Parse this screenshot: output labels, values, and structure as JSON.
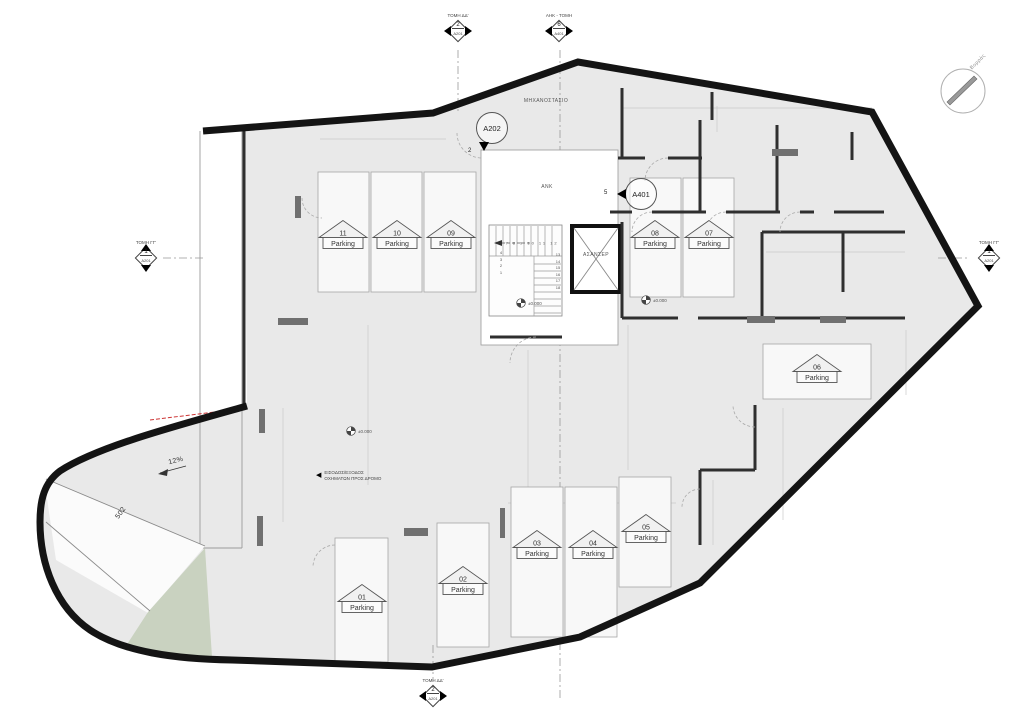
{
  "plan": {
    "labels": {
      "machine_room": "ΜΗΧΑΝΟΣΤΑΣΙΟ",
      "elevator_lobby": "ΑΝΚ",
      "elevator": "ΑΣΑΝΣΕΡ",
      "north": "Βορράς",
      "ramp_slope": "12%",
      "ramp_width": "502",
      "exit_note_line1": "ΕΙΣΟΔΟΣ/ΕΞΟΔΟΣ",
      "exit_note_line2": "ΟΧΗΜΑΤΩΝ ΠΡΟΣ ΔΡΟΜΟ"
    },
    "stairs": {
      "run_numbers": "7 8 9 10 11 12",
      "left_numbers": "4 3 2 1",
      "side_numbers": "13 14 15 16 17 18"
    },
    "colors": {
      "wall": "#141414",
      "floor": "#e9e9e9",
      "green_area": "#c9d2c0",
      "red_line": "#cc3333"
    }
  },
  "section_markers": [
    {
      "label": "ΤΟΜΗ ΔΔ'",
      "number": "2",
      "sheet": "A201",
      "x": 458,
      "y": 28,
      "orient": "h"
    },
    {
      "label": "ΑΗΚ - ΤΟΜΗ",
      "number": "6",
      "sheet": "A401",
      "x": 559,
      "y": 28,
      "orient": "h"
    },
    {
      "label": "ΤΟΜΗ ΓΓ'",
      "number": "1",
      "sheet": "A201",
      "x": 146,
      "y": 255,
      "orient": "v"
    },
    {
      "label": "ΤΟΜΗ ΓΓ'",
      "number": "1",
      "sheet": "A201",
      "x": 989,
      "y": 255,
      "orient": "v"
    },
    {
      "label": "ΤΟΜΗ ΔΔ'",
      "number": "2",
      "sheet": "A201",
      "x": 433,
      "y": 693,
      "orient": "h"
    }
  ],
  "detail_markers": [
    {
      "label": "A202",
      "number": "2",
      "x": 492,
      "y": 128,
      "orient": "down"
    },
    {
      "label": "A401",
      "number": "5",
      "x": 641,
      "y": 194,
      "orient": "left"
    }
  ],
  "parking": {
    "label": "Parking",
    "spaces": [
      {
        "number": "01",
        "x": 362,
        "y": 601
      },
      {
        "number": "02",
        "x": 463,
        "y": 583
      },
      {
        "number": "03",
        "x": 537,
        "y": 547
      },
      {
        "number": "04",
        "x": 593,
        "y": 547
      },
      {
        "number": "05",
        "x": 646,
        "y": 531
      },
      {
        "number": "06",
        "x": 817,
        "y": 371
      },
      {
        "number": "07",
        "x": 709,
        "y": 237
      },
      {
        "number": "08",
        "x": 655,
        "y": 237
      },
      {
        "number": "09",
        "x": 451,
        "y": 237
      },
      {
        "number": "10",
        "x": 397,
        "y": 237
      },
      {
        "number": "11",
        "x": 343,
        "y": 237
      }
    ]
  },
  "dimensions": [
    {
      "v": "877",
      "x": 383,
      "y": 135
    },
    {
      "v": "325",
      "x": 662,
      "y": 104
    },
    {
      "v": "300",
      "x": 748,
      "y": 104
    },
    {
      "v": "425",
      "x": 843,
      "y": 104
    },
    {
      "v": "70",
      "x": 717,
      "y": 118,
      "rot": 90
    },
    {
      "v": "275",
      "x": 800,
      "y": 249
    },
    {
      "v": "350",
      "x": 866,
      "y": 247
    },
    {
      "v": "558",
      "x": 548,
      "y": 291
    },
    {
      "v": "92",
      "x": 601,
      "y": 296,
      "rot": 90
    },
    {
      "v": "720",
      "x": 590,
      "y": 501
    },
    {
      "v": "215",
      "x": 713,
      "y": 511,
      "rot": 90
    },
    {
      "v": "405",
      "x": 699,
      "y": 526,
      "rot": 90
    },
    {
      "v": "1100",
      "x": 368,
      "y": 407,
      "rot": 90
    },
    {
      "v": "860",
      "x": 528,
      "y": 419,
      "rot": 90
    },
    {
      "v": "620",
      "x": 628,
      "y": 397,
      "rot": 90
    },
    {
      "v": "460",
      "x": 283,
      "y": 467,
      "rot": 90
    },
    {
      "v": "278",
      "x": 783,
      "y": 466,
      "rot": 90
    },
    {
      "v": "300",
      "x": 906,
      "y": 362,
      "rot": 90
    },
    {
      "v": "90",
      "x": 306,
      "y": 377
    },
    {
      "v": "80",
      "x": 288,
      "y": 377
    }
  ],
  "level_markers": [
    {
      "value": "±0.000",
      "x": 516,
      "y": 303
    },
    {
      "value": "±0.000",
      "x": 641,
      "y": 300
    },
    {
      "value": "±0.000",
      "x": 346,
      "y": 431
    }
  ]
}
